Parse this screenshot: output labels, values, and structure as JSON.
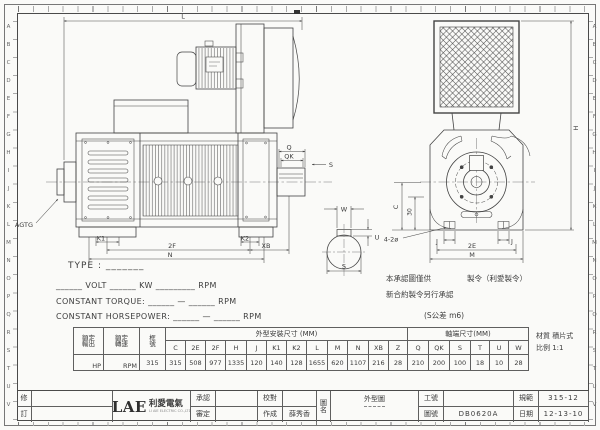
{
  "frame": {
    "row_letters": [
      "A",
      "B",
      "C",
      "D",
      "E",
      "F",
      "G",
      "H",
      "I",
      "J",
      "K",
      "L",
      "M",
      "N",
      "O",
      "P",
      "Q",
      "R",
      "S",
      "T",
      "U",
      "V"
    ]
  },
  "drawing": {
    "labels": {
      "L": "L",
      "Q": "Q",
      "QK": "QK",
      "S": "S",
      "K1": "K1",
      "K2": "K2",
      "F2": "2F",
      "N": "N",
      "XB": "XB",
      "AGTG": "AGTG",
      "H": "H",
      "C": "C",
      "D30": "30",
      "HOLES": "4-2ø",
      "J": "J",
      "E2": "2E",
      "M": "M",
      "W": "W",
      "U": "U"
    }
  },
  "spec": {
    "type_line": "TYPE : _______",
    "rating_line": "______ VOLT ______ KW _________ RPM",
    "torque_line": "CONSTANT TORQUE: ______ — ______ RPM",
    "power_line": "CONSTANT HORSEPOWER: ______ — ______ RPM"
  },
  "notes": {
    "approval_1": "本承認圖僅供",
    "approval_2": "製令（利愛製令）",
    "approval_3": "新合約製令另行承認",
    "tolerance": "(S公差 m6)",
    "material": "材質 積片式",
    "scale": "比例 1:1"
  },
  "table": {
    "h_output": [
      "額定",
      "輸出"
    ],
    "h_speed": [
      "額定",
      "轉速"
    ],
    "h_frame": [
      "框",
      "號"
    ],
    "h_outline": "外型安裝尺寸 (MM)",
    "h_shaft": "軸端尺寸(MM)",
    "dim_cols": [
      "C",
      "2E",
      "2F",
      "H",
      "J",
      "K1",
      "K2",
      "L",
      "M",
      "N",
      "XB",
      "Z",
      "Q",
      "QK",
      "S",
      "T",
      "U",
      "W"
    ],
    "dim_vals": [
      "315",
      "508",
      "977",
      "1335",
      "120",
      "140",
      "128",
      "1655",
      "620",
      "1107",
      "216",
      "28",
      "210",
      "200",
      "100",
      "18",
      "10",
      "28"
    ],
    "output_val": "HP",
    "speed_val": "RPM",
    "frame_val": "315"
  },
  "titleblock": {
    "rev_top": "修",
    "rev_bottom": "訂",
    "logo_text": "LAE",
    "logo_cn": "利愛電氣",
    "logo_sub": "LI AIE ELECTRIC CO.,LTD",
    "approve": "承認",
    "review": "審定",
    "proof": "校對",
    "made": "作成",
    "made_by": "薛秀香",
    "name_label": [
      "圖",
      "名"
    ],
    "drawing_name": "外型圖",
    "work_no": "工號",
    "work_no_val": "",
    "dwg_no": "圖號",
    "dwg_no_val": "DB0620A",
    "spec": "規範",
    "spec_val": "315-12",
    "date": "日期",
    "date_val": "12-13-10"
  }
}
